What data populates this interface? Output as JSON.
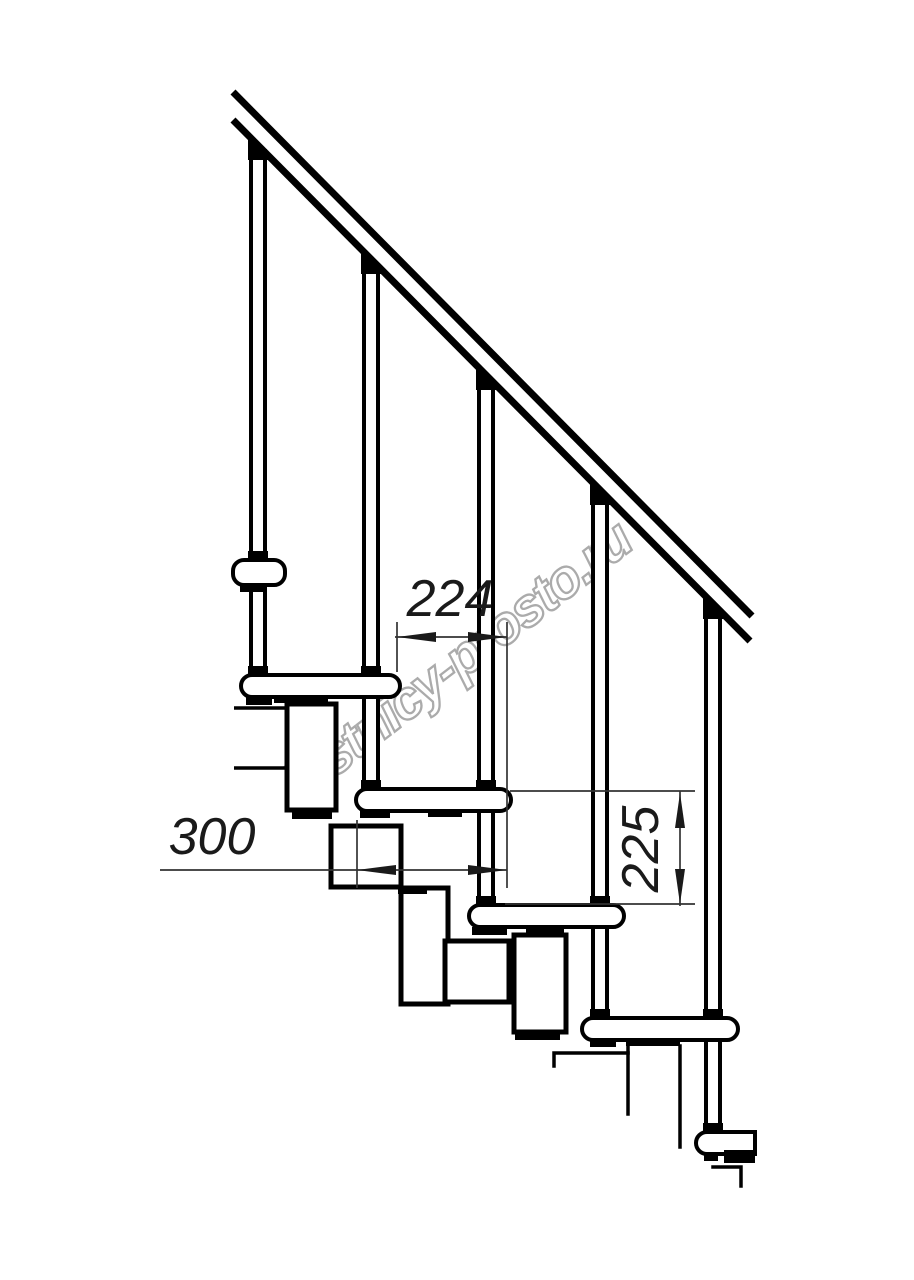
{
  "page": {
    "background": "#ffffff"
  },
  "drawing": {
    "subject": "Modular staircase side elevation",
    "line_color": "#000000",
    "watermark": {
      "text": "lestnicy-prosto.ru",
      "color": "#ababab"
    },
    "dimensions": [
      {
        "name": "step-run",
        "value": "224",
        "orientation": "horizontal"
      },
      {
        "name": "tread-depth",
        "value": "300",
        "orientation": "horizontal"
      },
      {
        "name": "riser-height",
        "value": "225",
        "orientation": "vertical"
      }
    ],
    "components": {
      "handrail_count": 1,
      "baluster_count": 5,
      "tread_count": 6,
      "stringer_module_count": 5
    }
  }
}
